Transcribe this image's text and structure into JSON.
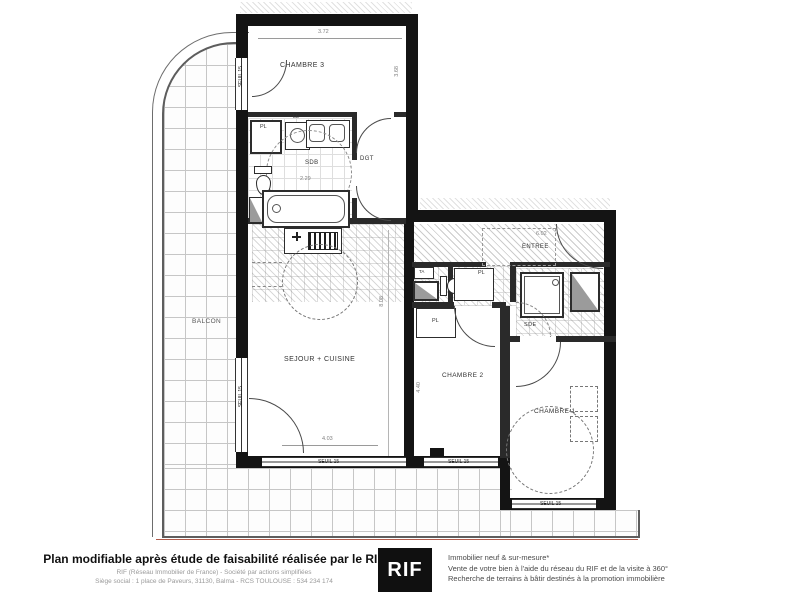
{
  "plan": {
    "room_labels": {
      "chambre3": "CHAMBRE 3",
      "sdb": "SDB",
      "dgt": "DGT",
      "entree": "ENTREE",
      "sejour_cuisine": "SEJOUR + CUISINE",
      "balcon": "BALCON",
      "chambre2": "CHAMBRE 2",
      "chambre1": "CHAMBRE 1",
      "sde": "SDE"
    },
    "fixture_labels": {
      "pl": "PL",
      "ll": "LL",
      "ta": "TA"
    },
    "window_label": "SEUIL 15",
    "dimensions": {
      "chambre3_width": "3.72",
      "chambre3_height": "3.68",
      "sdb_width": "2.29",
      "entree_width": "6.02",
      "sejour_width": "4.03",
      "sejour_height": "8.08",
      "chambre2_height": "4.40"
    }
  },
  "footer": {
    "headline": "Plan modifiable après étude de faisabilité réalisée par le RIF",
    "subline1": "RIF (Réseau Immobilier de France)  -  Société par actions simplifiées",
    "subline2": "Siège social : 1 place de Paveurs, 31130, Balma  -  RCS TOULOUSE : 534 234 174",
    "logo_text": "RIF",
    "services": [
      "Immobilier neuf & sur-mesure*",
      "Vente de votre bien à l'aide du réseau du RIF et de la visite à 360°",
      "Recherche de terrains à bâtir destinés à la promotion immobilière"
    ]
  },
  "colors": {
    "wall": "#141414",
    "tile_line": "#c6c6c6",
    "logo_bg": "#101010",
    "logo_fg": "#ffffff",
    "railing_accent": "#b05a4a"
  }
}
